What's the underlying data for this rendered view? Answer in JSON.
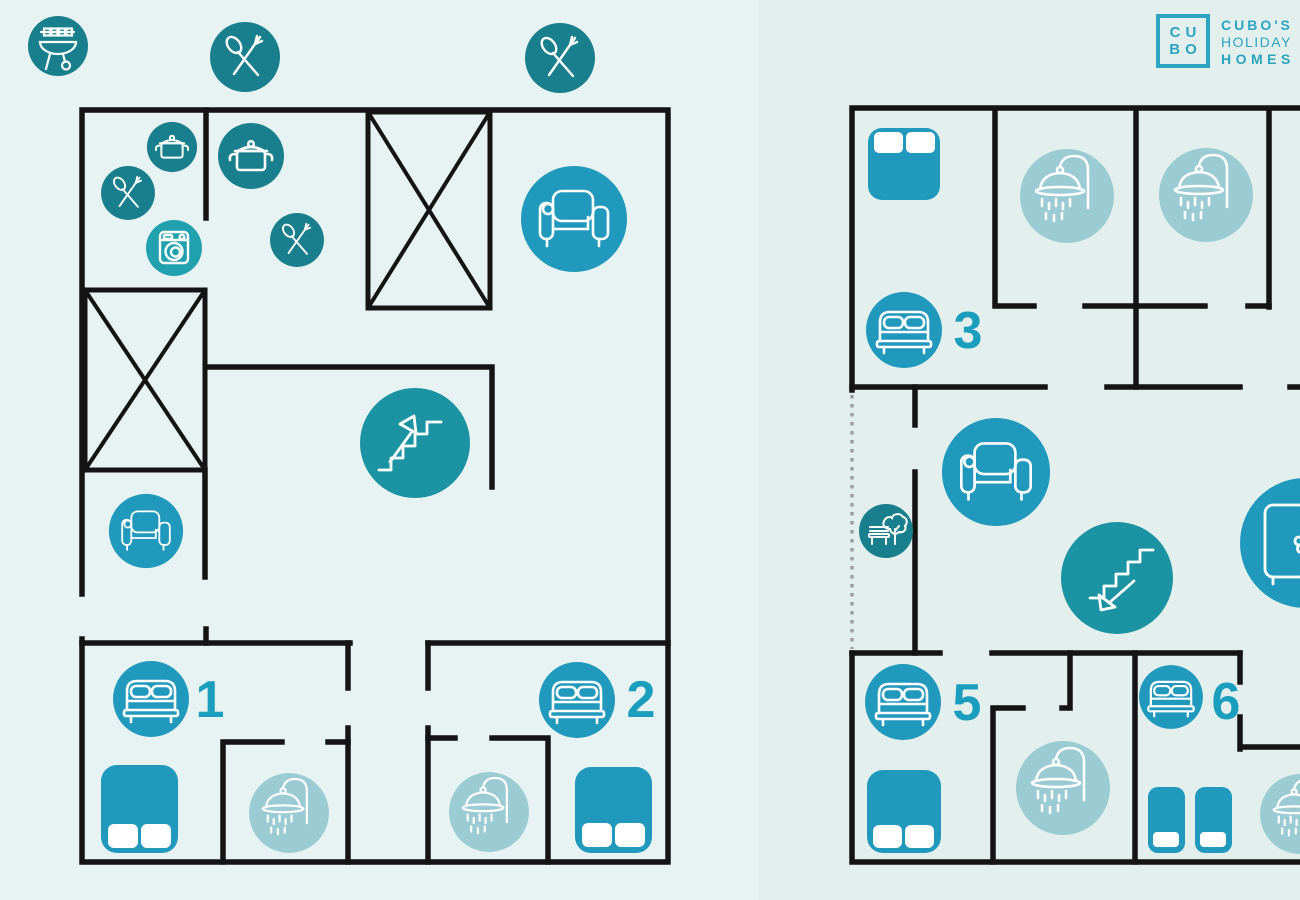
{
  "logo": {
    "box_line1": "CU",
    "box_line2": "BO",
    "brand_line1": "CUBO'S",
    "brand_line2": "HOLIDAY",
    "brand_line3": "HOMES"
  },
  "rooms": [
    {
      "number": "1",
      "floor": "ground"
    },
    {
      "number": "2",
      "floor": "ground"
    },
    {
      "number": "3",
      "floor": "upper"
    },
    {
      "number": "5",
      "floor": "upper"
    },
    {
      "number": "6",
      "floor": "upper"
    }
  ],
  "icons": [
    "bbq-grill",
    "dining-cutlery",
    "cooking-pot",
    "washing-machine",
    "sofa",
    "armchair",
    "stairs-up",
    "stairs-down",
    "double-bed",
    "single-bed",
    "shower",
    "wardrobe",
    "garden-bench-tree"
  ],
  "palette": {
    "bg_left": "#e7f3f3",
    "bg_right": "#e3efed",
    "wall": "#141414",
    "dark_teal": "#1a7f8c",
    "teal": "#1b93a3",
    "washer_teal": "#21a0ad",
    "blue": "#2099bd",
    "light_blue": "#9bcbd3",
    "label_blue": "#1b9dbd",
    "logo_teal": "#2aa4bf",
    "dots_gray": "#9e9e9e"
  }
}
